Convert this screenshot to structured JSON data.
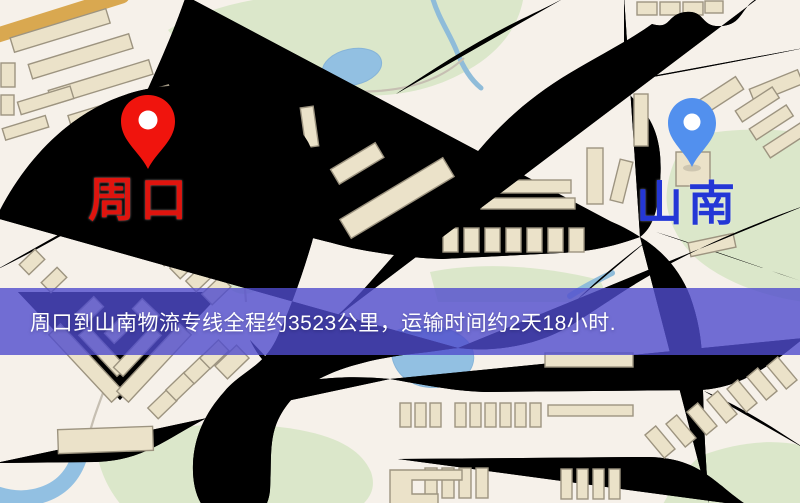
{
  "banner": {
    "text": "周口到山南物流专线全程约3523公里，运输时间约2天18小时.",
    "bg_color": "rgba(80,76,205,0.8)",
    "text_color": "#ffffff"
  },
  "markers": [
    {
      "id": "origin",
      "label": "周口",
      "pin_color": "#f0140d",
      "label_color": "#df140e"
    },
    {
      "id": "destination",
      "label": "山南",
      "pin_color": "#5290ee",
      "label_color": "#2437d6"
    }
  ],
  "map": {
    "palette": {
      "background": "#f6f1ea",
      "road_fill": "#f3d06e",
      "road_casing": "#d9a850",
      "park": "#dbe7ca",
      "water": "#92c0e2",
      "building": "#ebe2c9",
      "railway": "#23242c"
    }
  }
}
